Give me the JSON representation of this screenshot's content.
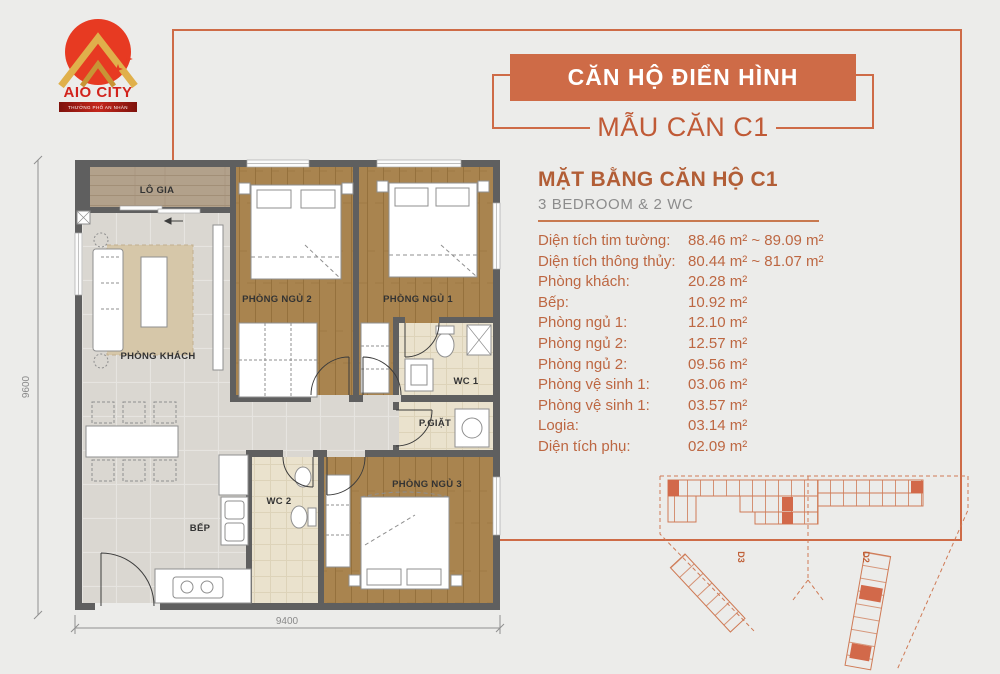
{
  "colors": {
    "bg": "#ECECEA",
    "accent": "#CE6B47",
    "orange_text": "#BD6742",
    "title": "#B25E36",
    "gray_text": "#8C8C8C"
  },
  "logo": {
    "title": "AIO CITY",
    "tagline": "THƯỞNG PHỐ AN NHÀN"
  },
  "header": {
    "banner": "CĂN HỘ ĐIỂN HÌNH",
    "model": "MẪU CĂN C1"
  },
  "plan_info": {
    "title": "MẶT BẰNG CĂN HỘ C1",
    "subtitle": "3 BEDROOM & 2 WC",
    "specs": [
      {
        "label": "Diện tích tim tường:",
        "value": "88.46 m² ~ 89.09 m²"
      },
      {
        "label": "Diện tích thông thủy:",
        "value": "80.44 m² ~ 81.07 m²"
      },
      {
        "label": "Phòng khách:",
        "value": "20.28 m²"
      },
      {
        "label": "Bếp:",
        "value": "10.92 m²"
      },
      {
        "label": "Phòng ngủ 1:",
        "value": "12.10 m²"
      },
      {
        "label": "Phòng ngủ 2:",
        "value": "12.57 m²"
      },
      {
        "label": "Phòng ngủ 2:",
        "value": "09.56 m²"
      },
      {
        "label": "Phòng vệ sinh 1:",
        "value": "03.06 m²"
      },
      {
        "label": "Phòng vệ sinh 1:",
        "value": "03.57 m²"
      },
      {
        "label": "Logia:",
        "value": "03.14 m²"
      },
      {
        "label": "Diện tích phụ:",
        "value": "02.09 m²"
      }
    ]
  },
  "floorplan": {
    "rooms": {
      "logia": "LÔ GIA",
      "bedroom2": "PHÒNG NGỦ 2",
      "bedroom1": "PHÒNG NGỦ 1",
      "living": "PHÒNG KHÁCH",
      "wc1": "WC 1",
      "laundry": "P.GIẶT",
      "wc2": "WC 2",
      "kitchen": "BẾP",
      "bedroom3": "PHÒNG NGỦ 3"
    },
    "dim_height": "9600",
    "dim_width": "9400"
  },
  "siteplan": {
    "blocks": [
      "D3",
      "D2"
    ]
  }
}
